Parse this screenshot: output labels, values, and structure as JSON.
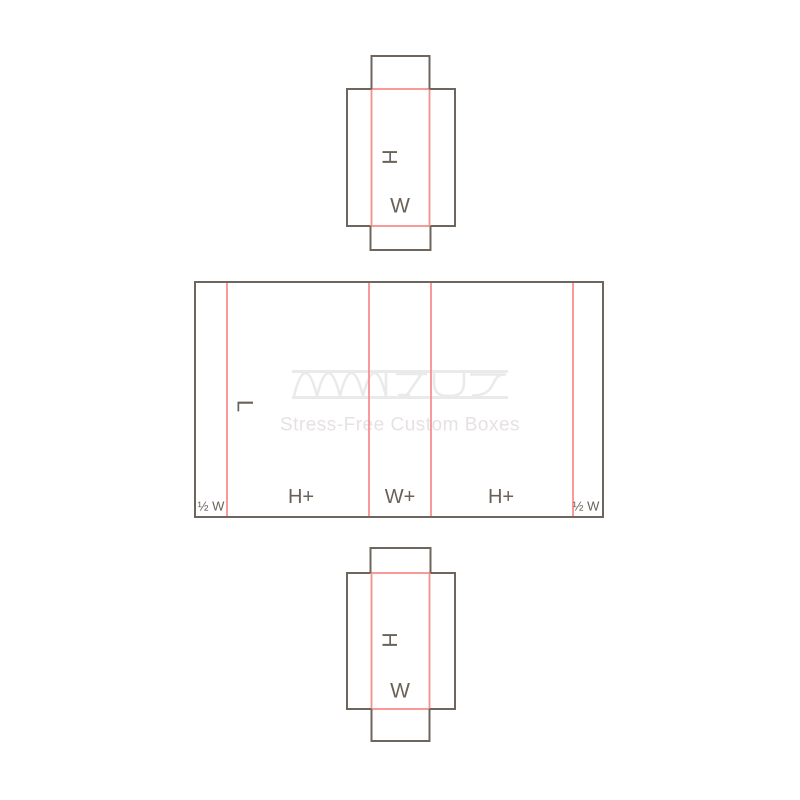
{
  "colors": {
    "background": "#ffffff",
    "cut_line": "#6e665c",
    "crease_line": "#f98f8d",
    "label_text": "#6a6258",
    "watermark_logo": "#eaeaea",
    "watermark_tagline": "#e7e2e2"
  },
  "panels": {
    "top_flap": {
      "height_label": "H",
      "width_label": "W"
    },
    "main": {
      "length_label": "L",
      "section_labels": [
        "½ W",
        "H+",
        "W+",
        "H+",
        "½ W"
      ]
    },
    "bottom_flap": {
      "height_label": "H",
      "width_label": "W"
    }
  },
  "watermark": {
    "logo": "corrugated-wave-wordmark",
    "tagline": "Stress-Free Custom Boxes"
  }
}
